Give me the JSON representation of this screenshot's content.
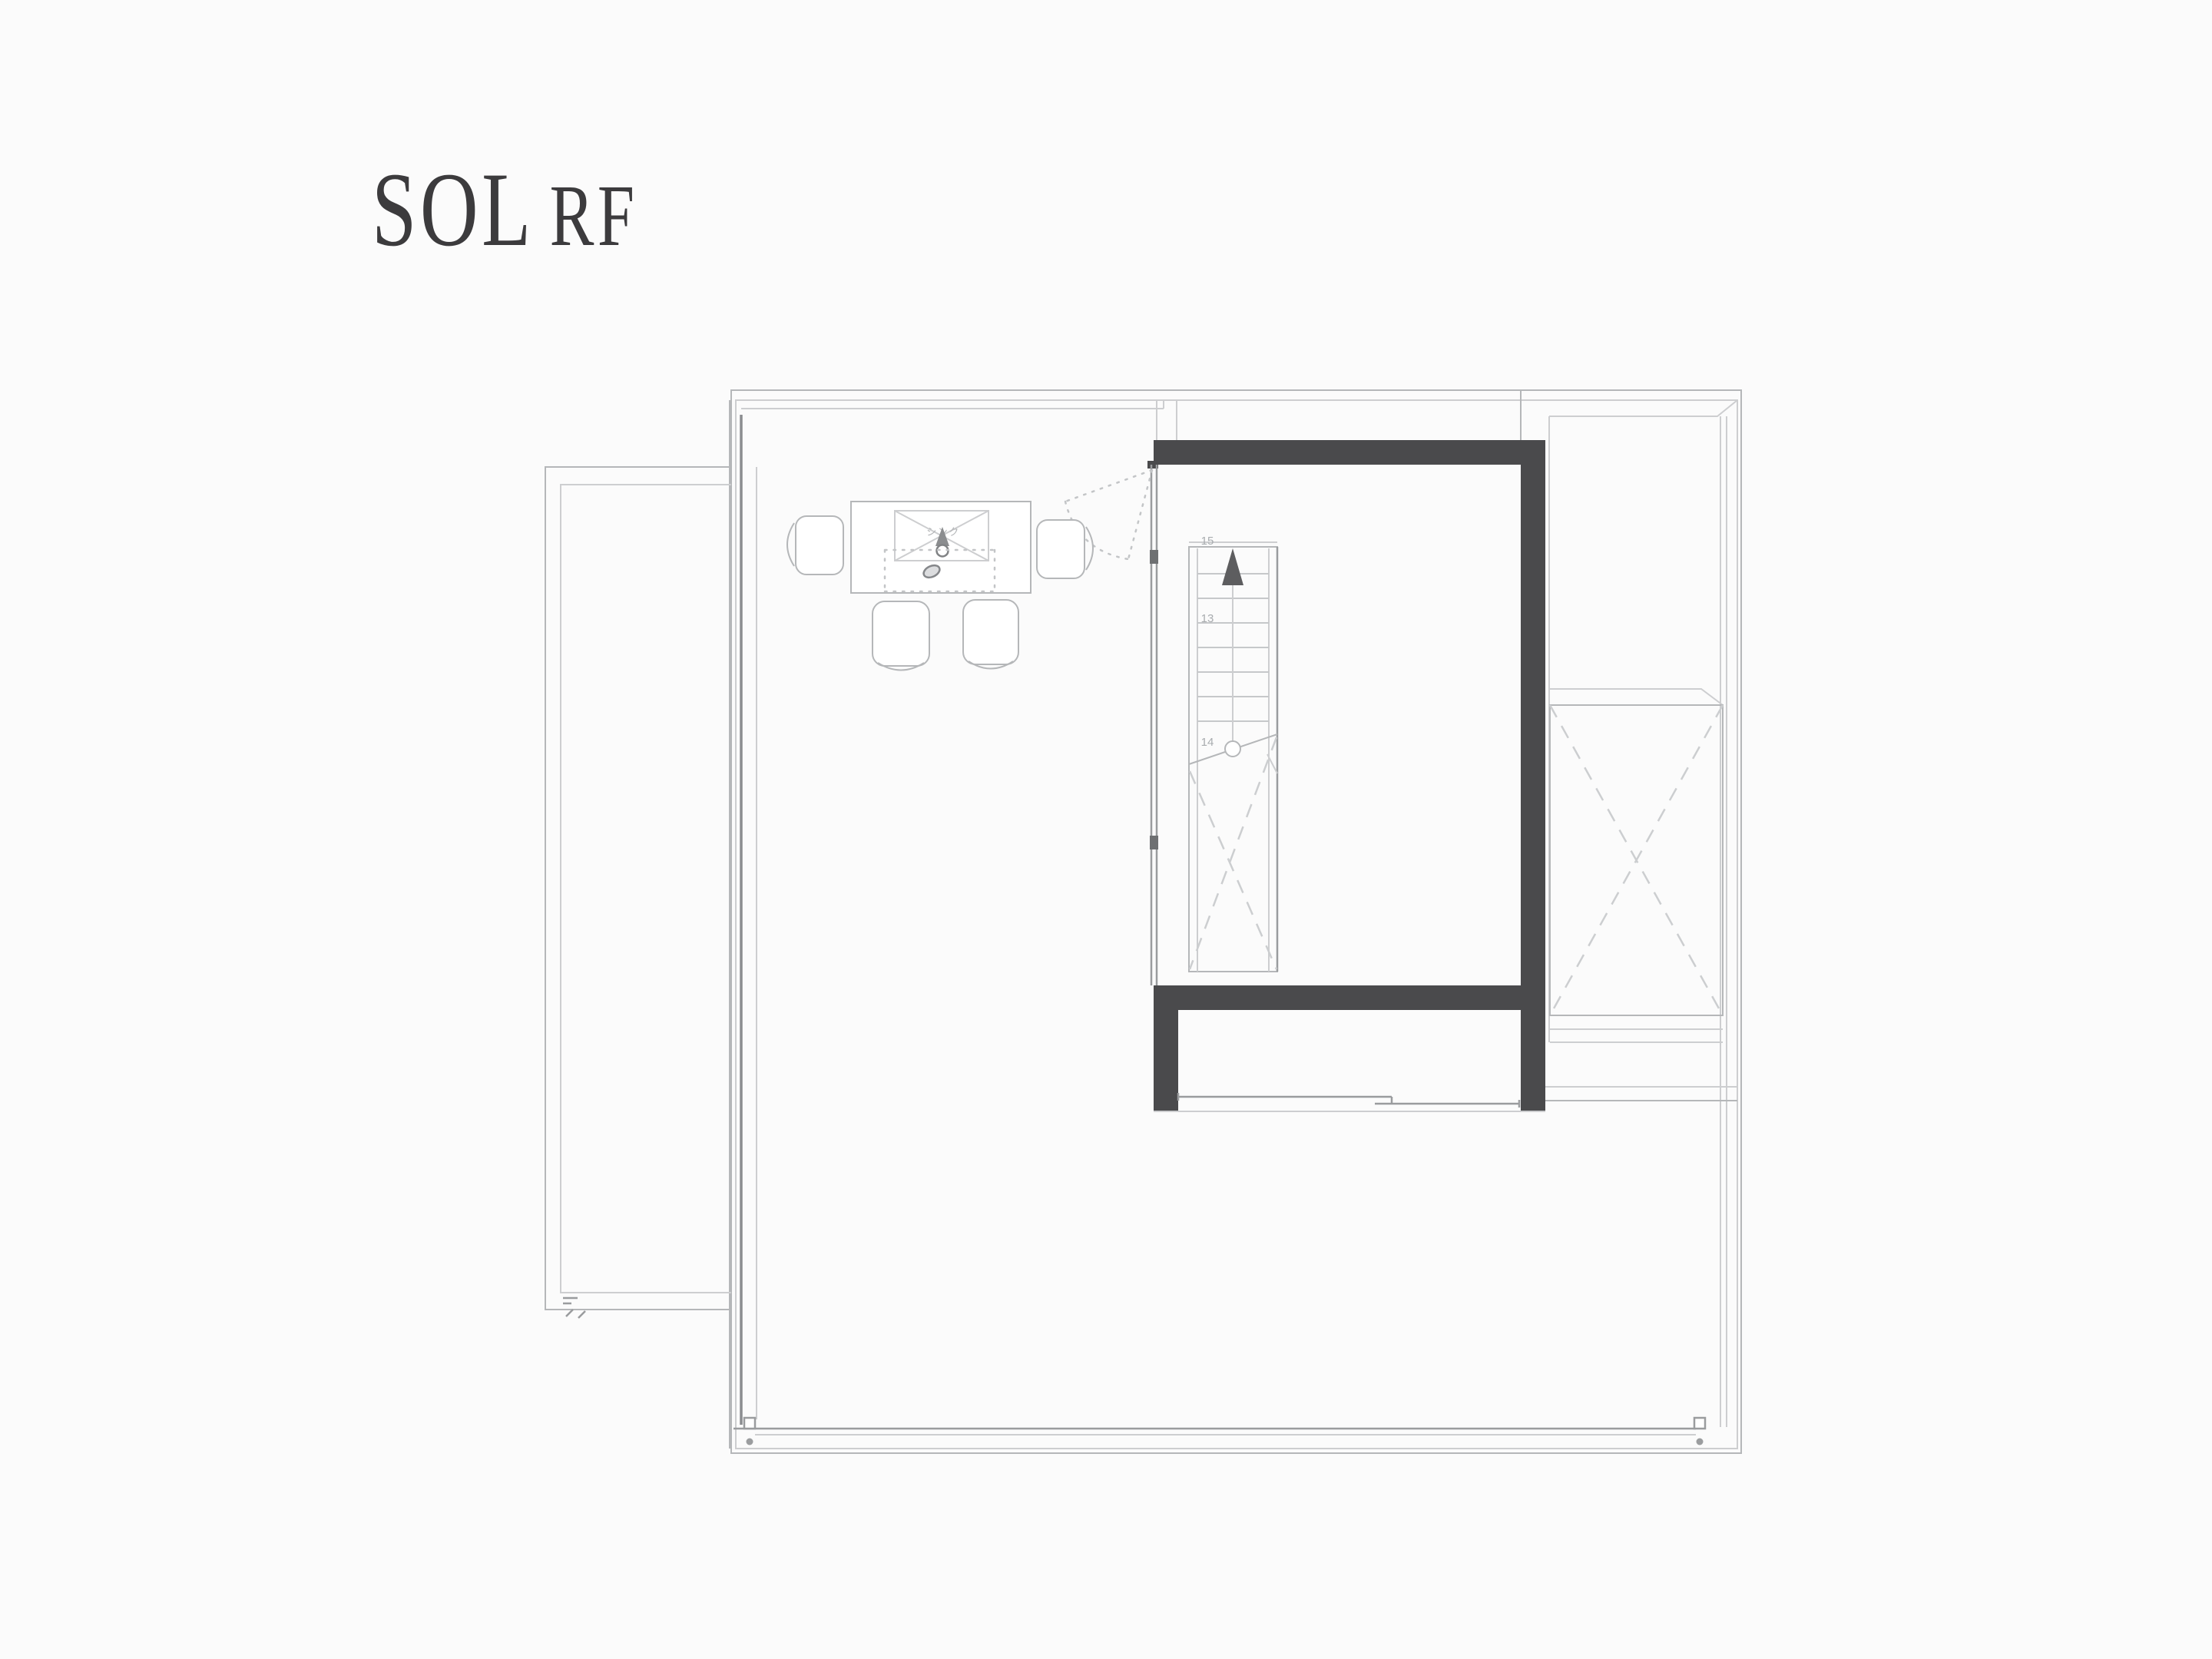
{
  "title": {
    "project": "SOL",
    "floor": "RF"
  },
  "plan": {
    "sink": {
      "label": "シンク"
    },
    "stairs": {
      "direction": "up",
      "numbers": [
        "15",
        "13",
        "14"
      ]
    },
    "colors": {
      "background": "#fbfbfb",
      "title_text": "#3c3b3d",
      "wall_dark": "#4a4a4c",
      "mullion_dark": "#6e7072",
      "line": "#b5b7b9",
      "line_dark": "#8b8d90",
      "line_faint": "#cdced0",
      "dashed": "#ccced0",
      "arrow": "#5d5d5f"
    }
  }
}
